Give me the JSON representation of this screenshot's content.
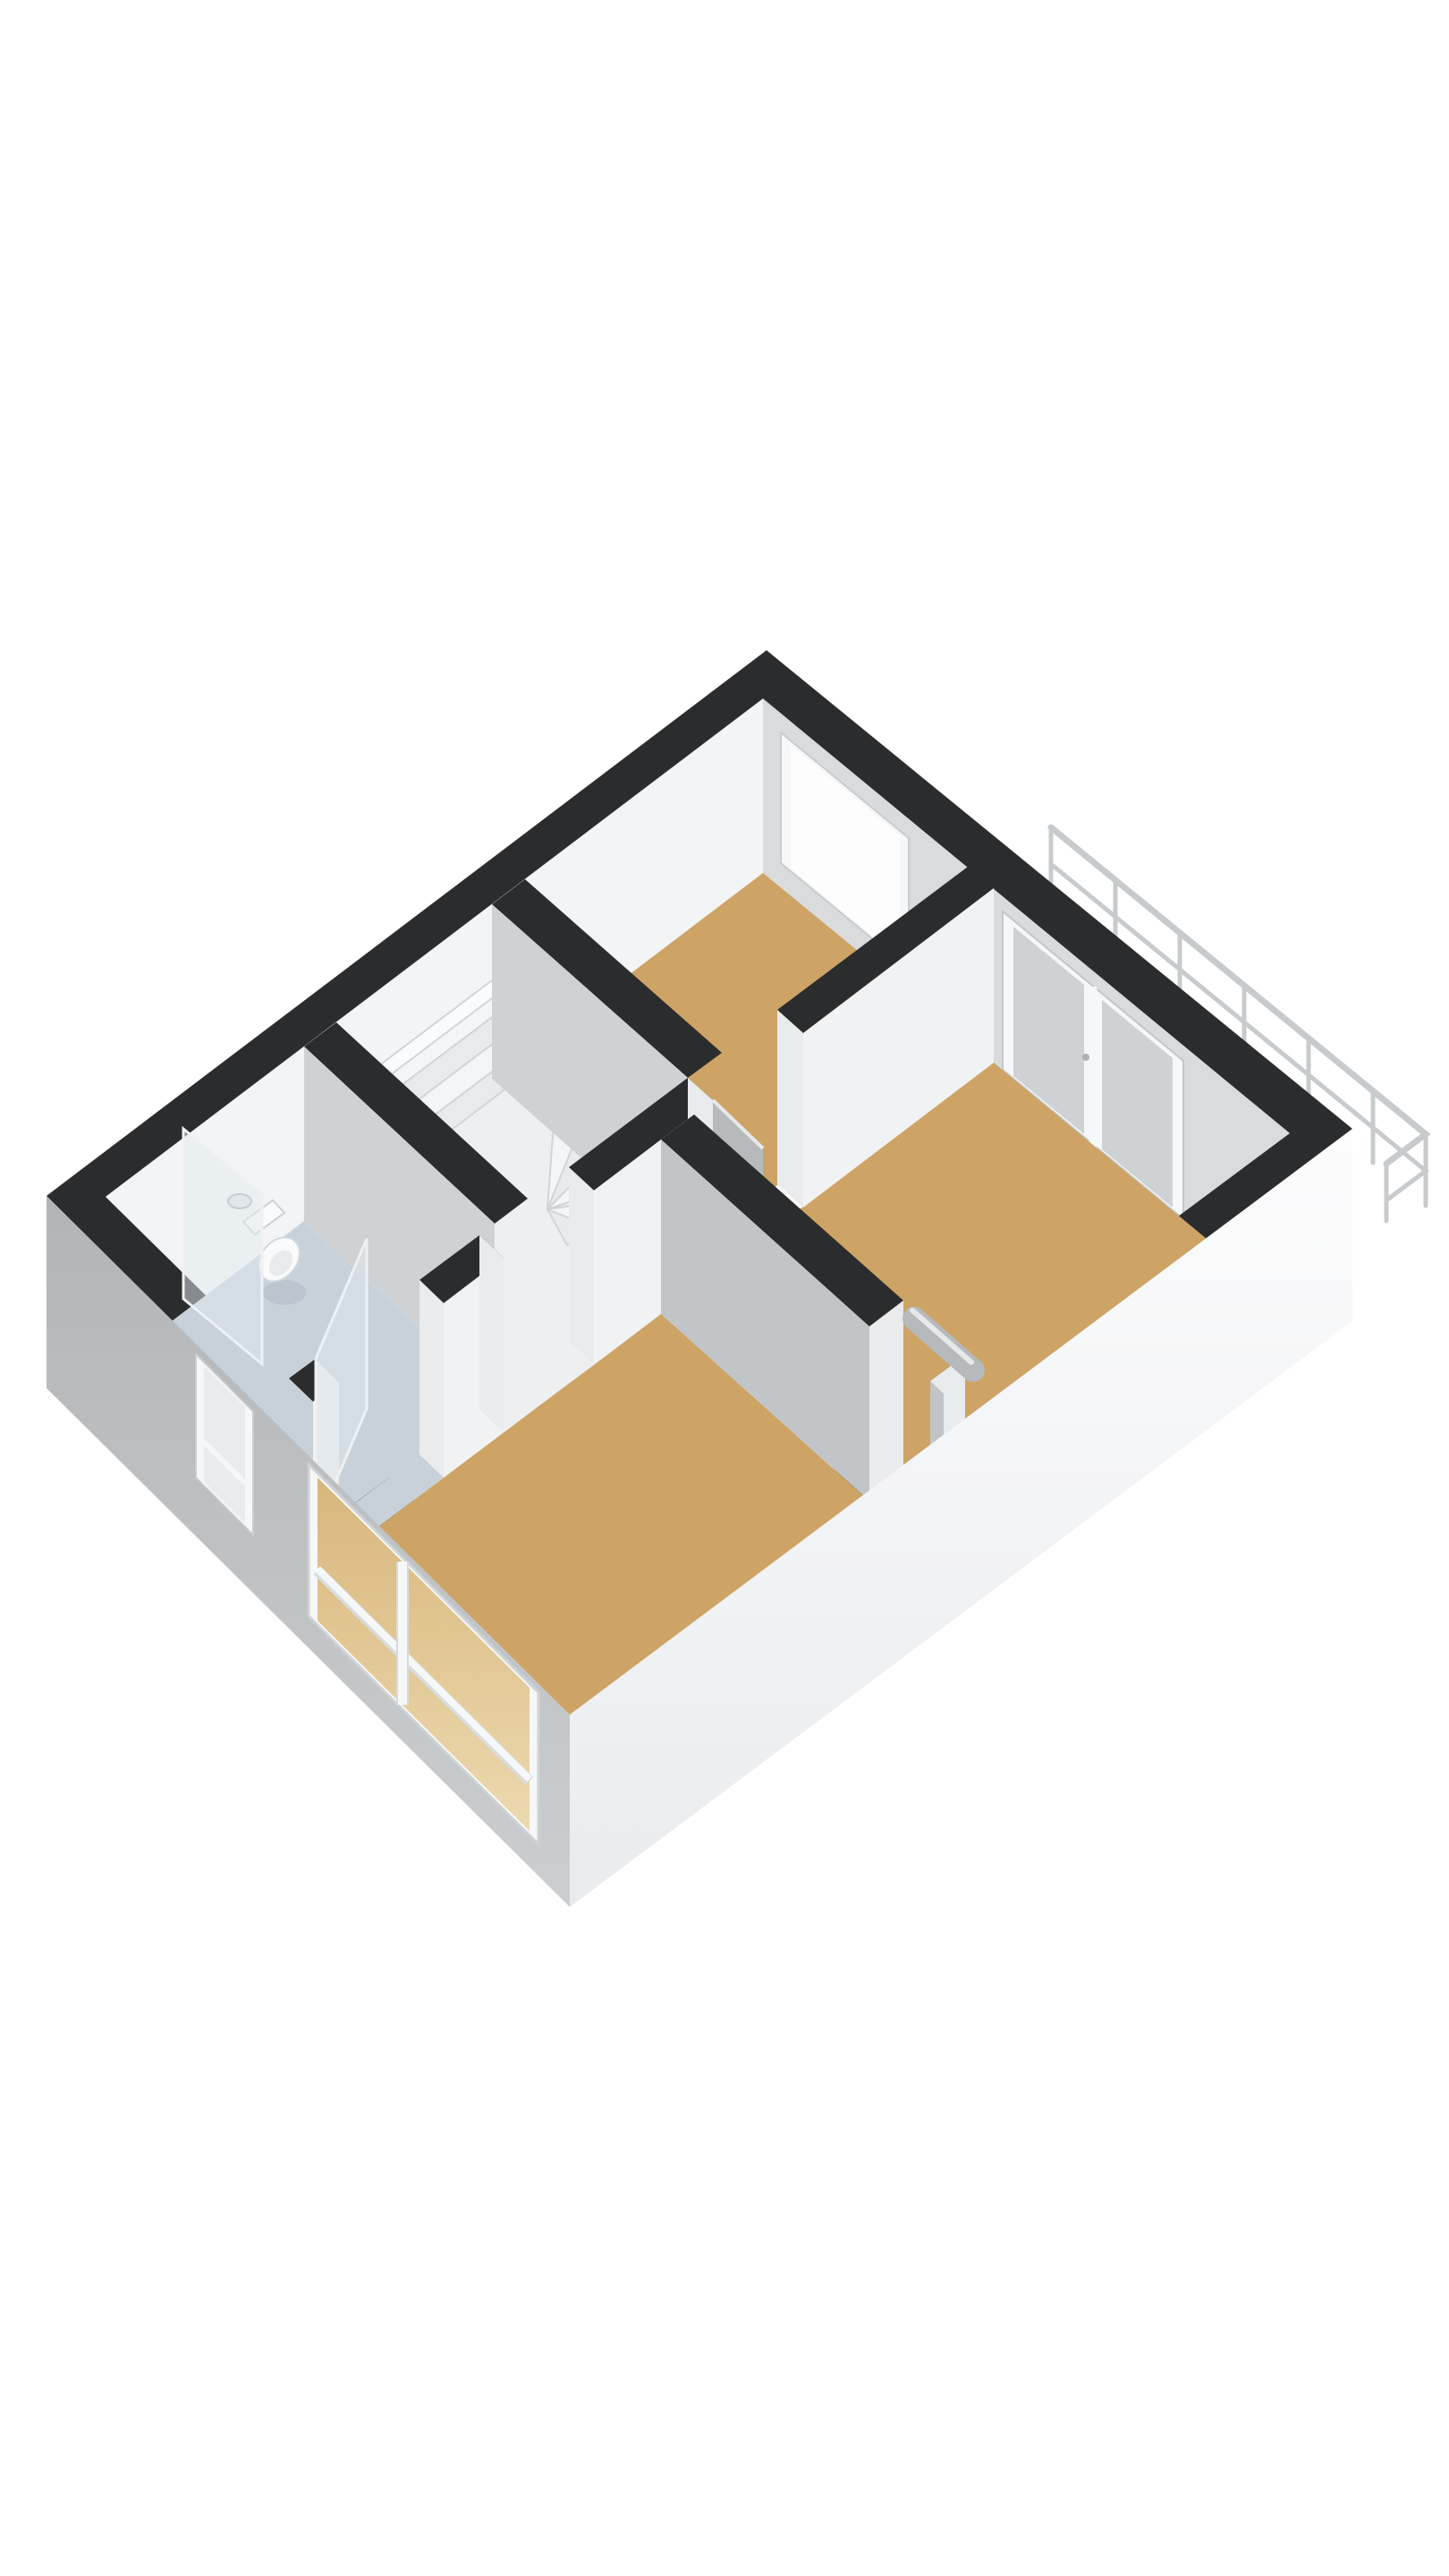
{
  "scene": {
    "type": "3d-floorplan-render",
    "view": "isometric-top-down",
    "background": "#ffffff",
    "rooms": [
      {
        "name": "bedroom-top",
        "floor": "wood"
      },
      {
        "name": "bedroom-right",
        "floor": "wood"
      },
      {
        "name": "bedroom-bottom",
        "floor": "wood"
      },
      {
        "name": "toilet-room",
        "floor": "tile-blue-gray",
        "fixtures": [
          "toilet",
          "hand-basin",
          "glass-screen",
          "glass-door"
        ]
      },
      {
        "name": "stairwell",
        "floor": "light",
        "fixtures": [
          "winder-staircase"
        ]
      }
    ],
    "openings": [
      {
        "name": "window-top-room",
        "wall": "north-east",
        "type": "window"
      },
      {
        "name": "french-doors-balcony",
        "wall": "north-east",
        "type": "double-door"
      },
      {
        "name": "window-narrow-toilet",
        "wall": "south-west",
        "type": "window"
      },
      {
        "name": "window-large-bottom-room",
        "wall": "south-west",
        "type": "window"
      },
      {
        "name": "door-top-room",
        "type": "interior-door-open"
      },
      {
        "name": "door-big-room",
        "type": "interior-door-open"
      },
      {
        "name": "doorway-stairwell",
        "type": "open-passage"
      },
      {
        "name": "toilet-glass-door",
        "type": "glass-door"
      }
    ],
    "exterior_features": [
      "balcony-railing"
    ]
  },
  "palette": {
    "background": "#ffffff",
    "wall_top": "#2b2c2e",
    "wall_inner_nw": "#f3f4f5",
    "wall_inner_ne": "#d9dbdd",
    "face_bright": "#f1f2f3",
    "face_cap": "#e9ebec",
    "face_gray": "#c2c5c8",
    "face_gray_light": "#cfd2d4",
    "ext_sw_top": "#b2b4b6",
    "ext_sw_bottom": "#cbced0",
    "ext_se_top": "#fcfcfd",
    "ext_se_bottom": "#e9ebed",
    "floor_wood": "#cda466",
    "floor_toilet": "#c9d1d8",
    "floor_stair": "#edeff0",
    "step_a": "#f4f5f6",
    "step_b": "#e8eaec",
    "step_stroke": "#d2d5d8",
    "window_frame": "#f6f7f8",
    "window_frame_stroke": "#c9cdcf",
    "glass_bright": "#fdfdfe",
    "glass_doors": "#ced2d5",
    "glass_sw_top": "#d8b67c",
    "glass_sw_bottom": "#ecd9ae",
    "railing": "#c7cbce",
    "railing_light": "#e8eaec",
    "door_leaf": "#b6babd",
    "door_leaf_highlight": "#e6e8ea",
    "fixture_white": "#f9fafb",
    "fixture_stroke": "#d3d7da",
    "glass_panel_fill": "rgba(225,233,239,0.5)",
    "glass_panel_stroke": "#eef1f4",
    "soft_shadow": "rgba(159,176,188,0.35)"
  }
}
